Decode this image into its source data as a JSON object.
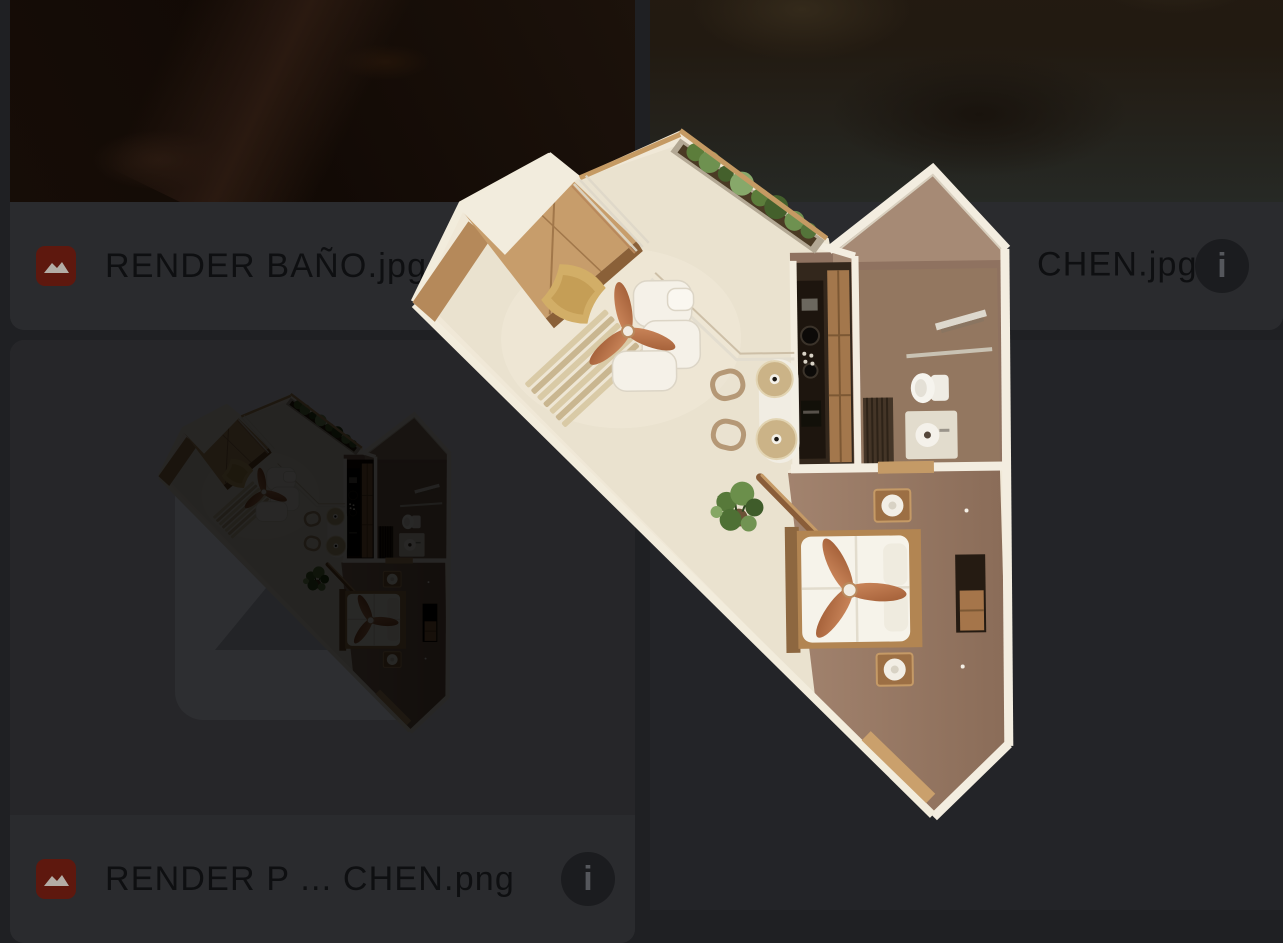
{
  "ui": {
    "theme": {
      "page_bg": "#1f2023",
      "card_bg": "#2a2b2e",
      "caption_text_color": "#0e0f11",
      "file_icon_bg": "#5e180e",
      "file_icon_glyph_color": "#b3ada6",
      "info_icon_bg": "#1b1c1f",
      "info_icon_glyph_color": "#55575c"
    },
    "icons": {
      "info_glyph": "i",
      "file_type_icon": "image-file-icon"
    },
    "cards": [
      {
        "position": "top-left",
        "filename": "RENDER BAÑO.jpg",
        "file_type": "image",
        "info_button_visible": false,
        "state": "dimmed-by-drag-overlay"
      },
      {
        "position": "top-right",
        "filename_visible": "CHEN.jpg",
        "file_type": "image",
        "info_button_visible": true,
        "state": "dimmed-by-drag-overlay, name partially covered by dragged item"
      },
      {
        "position": "bottom-left",
        "filename": "RENDER P ... CHEN.png",
        "file_type": "image",
        "info_button_visible": true,
        "state": "drag source, thumbnail dimmed with placeholder icon"
      }
    ],
    "drag": {
      "preview": "isometric-floor-plan-render",
      "rooms_depicted": [
        "living area",
        "kitchen strip",
        "bathroom with gabled wall",
        "bedroom"
      ]
    }
  }
}
